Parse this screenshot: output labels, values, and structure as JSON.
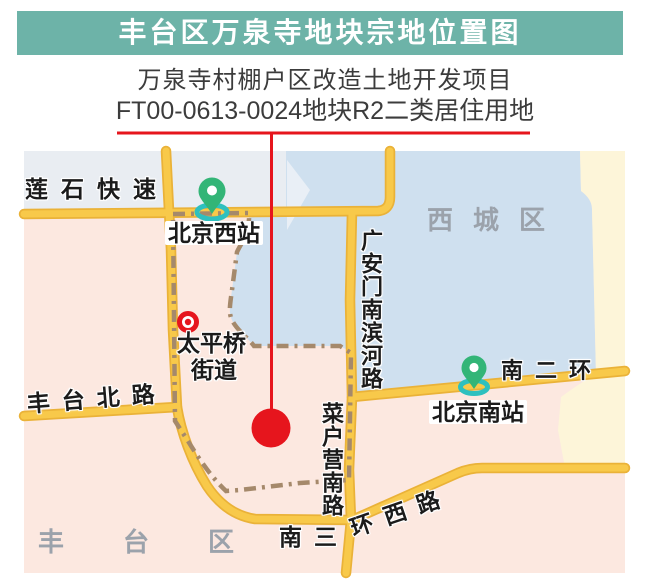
{
  "title": "丰台区万泉寺地块宗地位置图",
  "subtitle": {
    "line1": "万泉寺村棚户区改造土地开发项目",
    "line2": "FT00-0613-0024地块R2二类居住用地"
  },
  "map": {
    "districts": {
      "xicheng": "西城区",
      "fengtai": "丰台区"
    },
    "roads": {
      "lianshi_expressway": "莲石快速",
      "fengtai_north_road": "丰台北路",
      "guanganmen_south_binhe_road": "广安门南滨河路",
      "south_2nd_ring": "南二环",
      "caihuying_south_road": "菜户营南路",
      "south_3rd_ring_west_part1": "南三",
      "south_3rd_ring_west_part2": "环西路"
    },
    "stations": {
      "beijing_west": "北京西站",
      "beijing_south": "北京南站"
    },
    "subdistrict": {
      "line1": "太平桥",
      "line2": "街道"
    }
  },
  "colors": {
    "titlebar": "#6db3a8",
    "red": "#e6151d",
    "road-fill": "#f8c94a",
    "road-edge": "#eab238",
    "pink": "#fce8e0",
    "grayblue": "#e9edf2",
    "blue": "#cfe0ef",
    "blue-light": "#e9eff6",
    "cream": "#fdf5d9",
    "boundary": "#a5896b",
    "district-text": "#9ba2ab",
    "pin-green": "#33b577",
    "pin-teal": "#2ec0bf",
    "label-text": "#1b1b1b",
    "subtitle-text": "#3c3c3c"
  }
}
